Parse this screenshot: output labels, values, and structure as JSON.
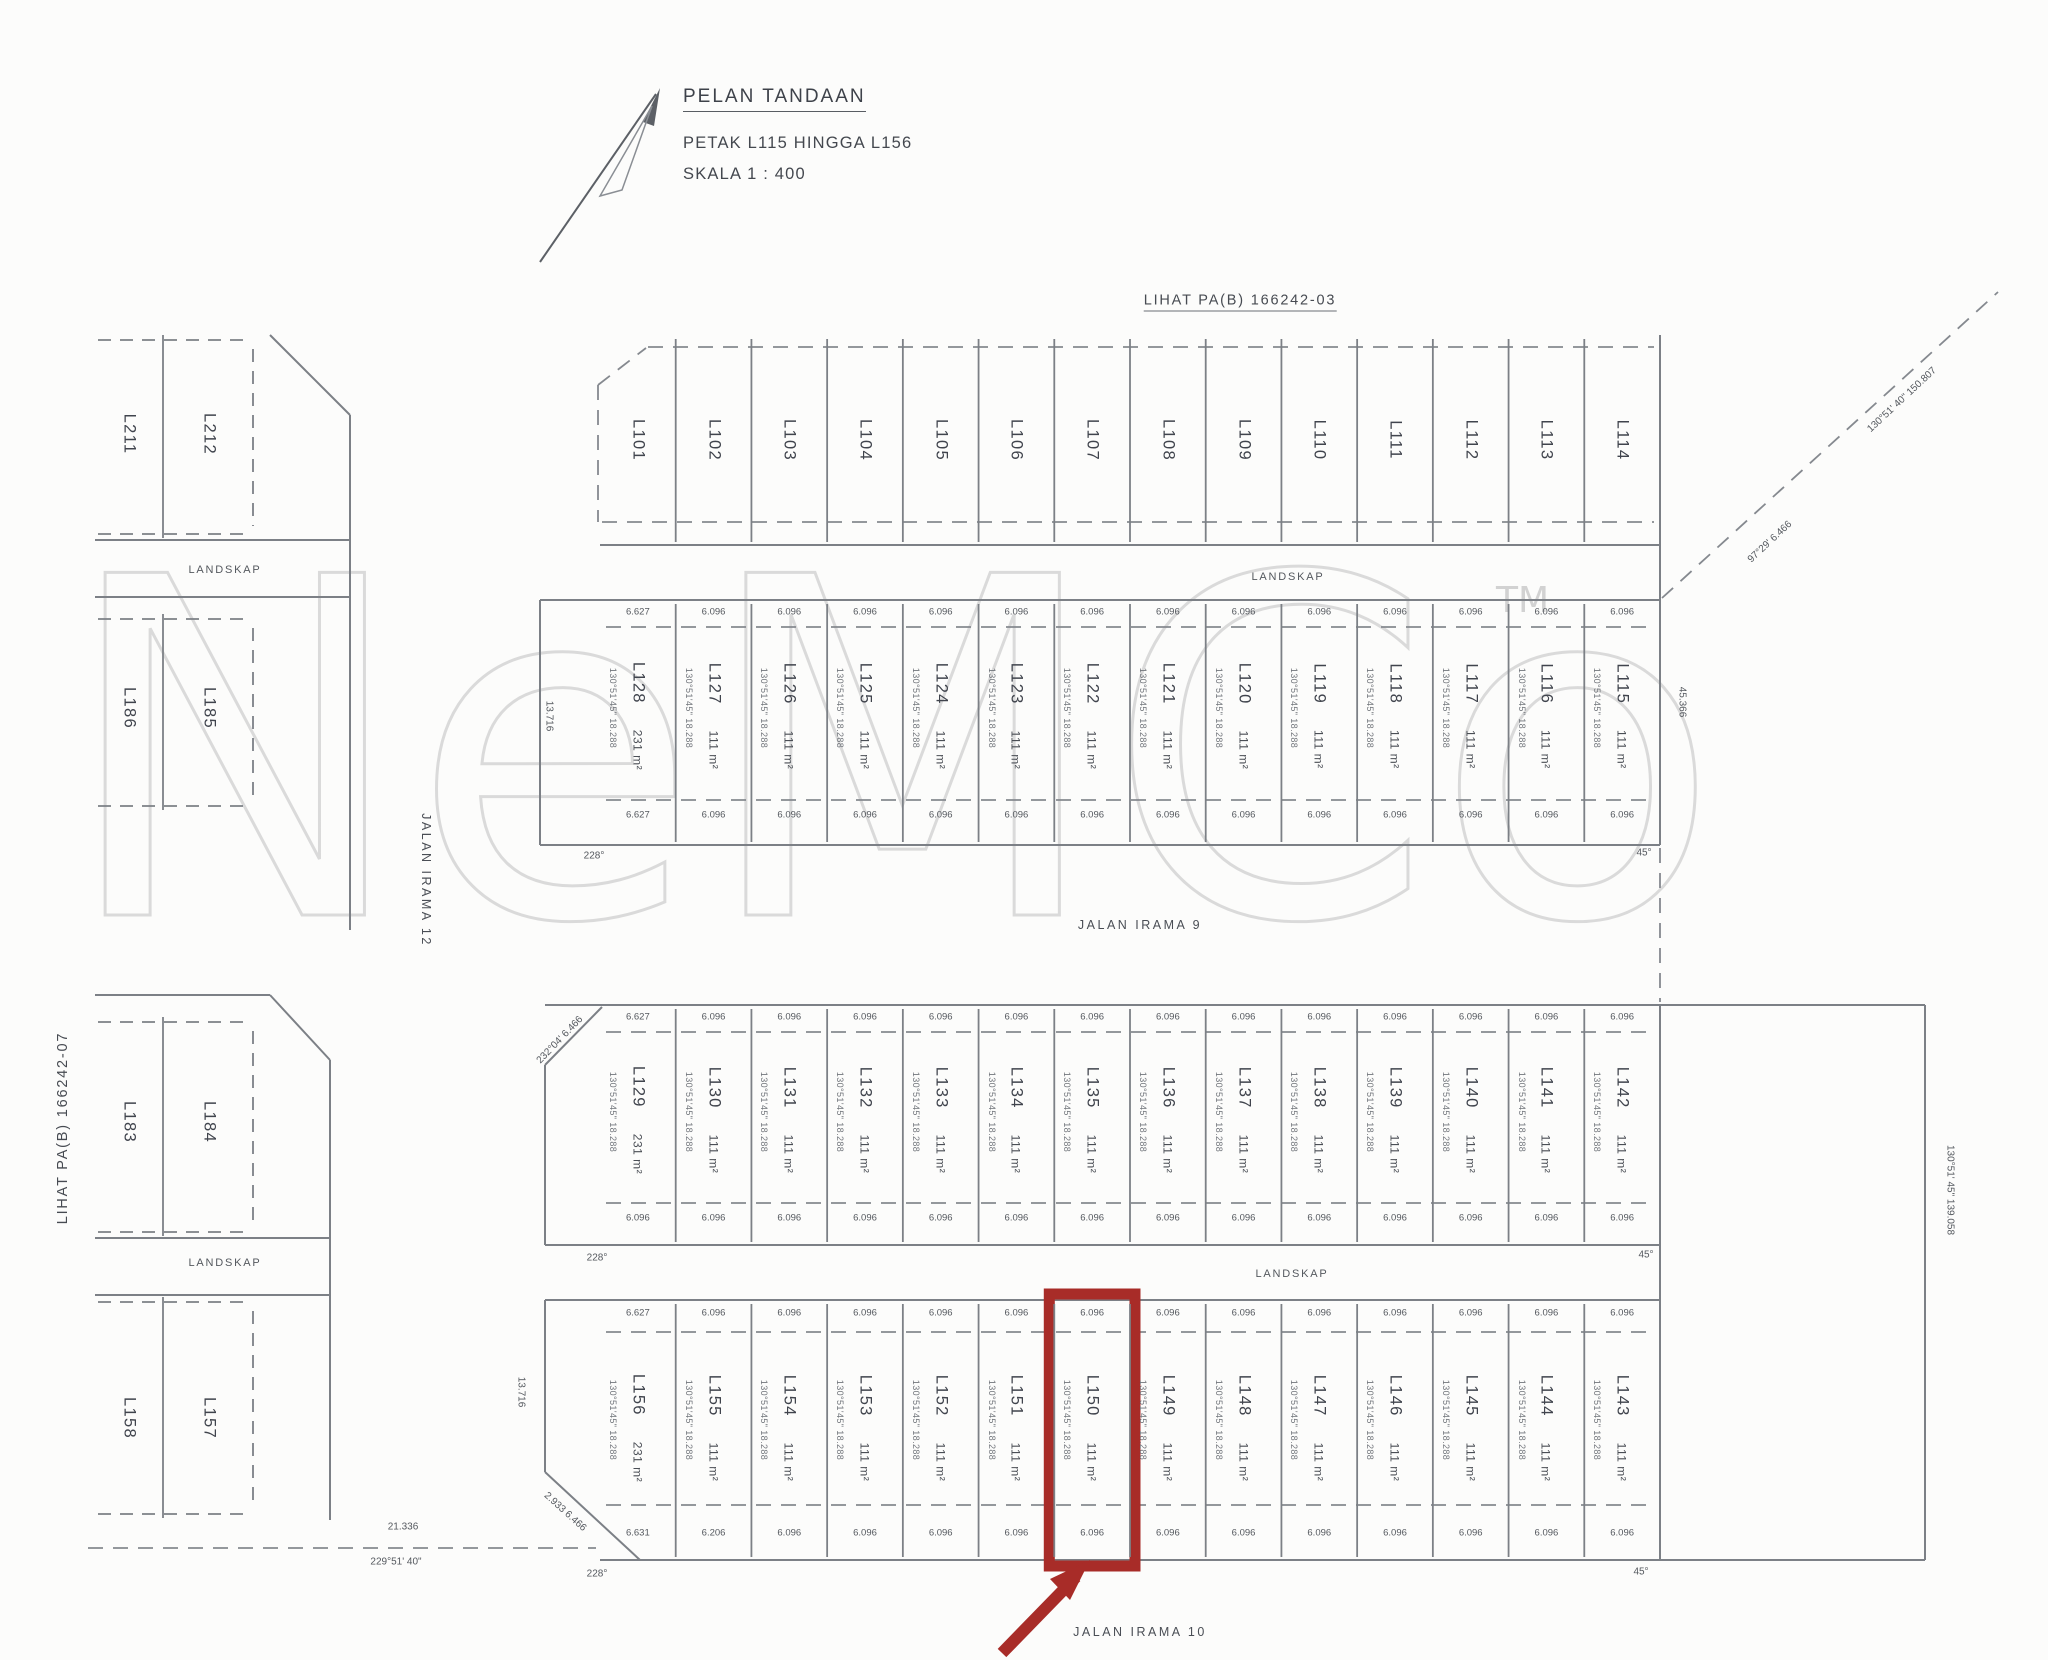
{
  "title_block": {
    "title": "PELAN TANDAAN",
    "subtitle": "PETAK L115 HINGGA L156",
    "scale": "SKALA 1 : 400"
  },
  "references": {
    "top": "LIHAT PA(B) 166242-03",
    "left": "LIHAT PA(B) 166242-07"
  },
  "roads": {
    "middle": "JALAN IRAMA 9",
    "bottom": "JALAN IRAMA 10",
    "left": "JALAN IRAMA 12"
  },
  "landskap_label": "LANDSKAP",
  "watermark": {
    "text": "NeMCo",
    "tm": "TM"
  },
  "highlight": {
    "lot_id": "L150",
    "color": "#a82c28"
  },
  "left_blocks": {
    "tl": {
      "lots": [
        "L211",
        "L212"
      ]
    },
    "ml": {
      "lots": [
        "L186",
        "L185"
      ]
    },
    "bl1": {
      "lots": [
        "L183",
        "L184"
      ]
    },
    "bl2": {
      "lots": [
        "L158",
        "L157"
      ]
    }
  },
  "rows": [
    {
      "name": "north-row",
      "lots": [
        "L101",
        "L102",
        "L103",
        "L104",
        "L105",
        "L106",
        "L107",
        "L108",
        "L109",
        "L110",
        "L111",
        "L112",
        "L113",
        "L114"
      ]
    },
    {
      "name": "upper-row",
      "lots": [
        "L128",
        "L127",
        "L126",
        "L125",
        "L124",
        "L123",
        "L122",
        "L121",
        "L120",
        "L119",
        "L118",
        "L117",
        "L116",
        "L115"
      ],
      "areas": [
        "231 m²",
        "111 m²",
        "111 m²",
        "111 m²",
        "111 m²",
        "111 m²",
        "111 m²",
        "111 m²",
        "111 m²",
        "111 m²",
        "111 m²",
        "111 m²",
        "111 m²",
        "111 m²"
      ],
      "bearing": "130°51'45\"  18.288",
      "top_dims": [
        "6.627",
        "6.096",
        "6.096",
        "6.096",
        "6.096",
        "6.096",
        "6.096",
        "6.096",
        "6.096",
        "6.096",
        "6.096",
        "6.096",
        "6.096",
        "6.096"
      ],
      "bottom_dims": [
        "6.627",
        "6.096",
        "6.096",
        "6.096",
        "6.096",
        "6.096",
        "6.096",
        "6.096",
        "6.096",
        "6.096",
        "6.096",
        "6.096",
        "6.096",
        "6.096"
      ]
    },
    {
      "name": "middle-row",
      "lots": [
        "L129",
        "L130",
        "L131",
        "L132",
        "L133",
        "L134",
        "L135",
        "L136",
        "L137",
        "L138",
        "L139",
        "L140",
        "L141",
        "L142"
      ],
      "areas": [
        "231 m²",
        "111 m²",
        "111 m²",
        "111 m²",
        "111 m²",
        "111 m²",
        "111 m²",
        "111 m²",
        "111 m²",
        "111 m²",
        "111 m²",
        "111 m²",
        "111 m²",
        "111 m²"
      ],
      "bearing": "130°51'45\"  18.288",
      "top_dims": [
        "6.627",
        "6.096",
        "6.096",
        "6.096",
        "6.096",
        "6.096",
        "6.096",
        "6.096",
        "6.096",
        "6.096",
        "6.096",
        "6.096",
        "6.096",
        "6.096"
      ],
      "bottom_dims": [
        "6.096",
        "6.096",
        "6.096",
        "6.096",
        "6.096",
        "6.096",
        "6.096",
        "6.096",
        "6.096",
        "6.096",
        "6.096",
        "6.096",
        "6.096",
        "6.096"
      ]
    },
    {
      "name": "south-row",
      "lots": [
        "L156",
        "L155",
        "L154",
        "L153",
        "L152",
        "L151",
        "L150",
        "L149",
        "L148",
        "L147",
        "L146",
        "L145",
        "L144",
        "L143"
      ],
      "areas": [
        "231 m²",
        "111 m²",
        "111 m²",
        "111 m²",
        "111 m²",
        "111 m²",
        "111 m²",
        "111 m²",
        "111 m²",
        "111 m²",
        "111 m²",
        "111 m²",
        "111 m²",
        "111 m²"
      ],
      "bearing": "130°51'45\"  18.288",
      "top_dims": [
        "6.627",
        "6.096",
        "6.096",
        "6.096",
        "6.096",
        "6.096",
        "6.096",
        "6.096",
        "6.096",
        "6.096",
        "6.096",
        "6.096",
        "6.096",
        "6.096"
      ],
      "bottom_dims": [
        "6.631",
        "6.206",
        "6.096",
        "6.096",
        "6.096",
        "6.096",
        "6.096",
        "6.096",
        "6.096",
        "6.096",
        "6.096",
        "6.096",
        "6.096",
        "6.096"
      ]
    }
  ],
  "annotations": [
    {
      "text": "21.336",
      "x": 403,
      "y": 1527,
      "rot": 0
    },
    {
      "text": "229°51' 40\"",
      "x": 396,
      "y": 1562,
      "rot": 0
    },
    {
      "text": "228°",
      "x": 594,
      "y": 856,
      "rot": 0
    },
    {
      "text": "228°",
      "x": 597,
      "y": 1258,
      "rot": 0
    },
    {
      "text": "228°",
      "x": 597,
      "y": 1574,
      "rot": 0
    },
    {
      "text": "45°",
      "x": 1644,
      "y": 853,
      "rot": 0
    },
    {
      "text": "45°",
      "x": 1646,
      "y": 1255,
      "rot": 0
    },
    {
      "text": "45°",
      "x": 1641,
      "y": 1572,
      "rot": 0
    },
    {
      "text": "13.716",
      "x": 549,
      "y": 716,
      "rot": 90
    },
    {
      "text": "13.716",
      "x": 521,
      "y": 1392,
      "rot": 90
    },
    {
      "text": "130°51' 40\"   150.807",
      "x": 1902,
      "y": 400,
      "rot": -43
    },
    {
      "text": "97°29'   6.466",
      "x": 1770,
      "y": 542,
      "rot": -43
    },
    {
      "text": "130°51' 45\"   139.058",
      "x": 1950,
      "y": 1190,
      "rot": 90
    },
    {
      "text": "45.366",
      "x": 1682,
      "y": 702,
      "rot": 90
    },
    {
      "text": "232°04'   6.466",
      "x": 560,
      "y": 1040,
      "rot": -46
    },
    {
      "text": "2.933   6.466",
      "x": 565,
      "y": 1512,
      "rot": 42
    }
  ]
}
